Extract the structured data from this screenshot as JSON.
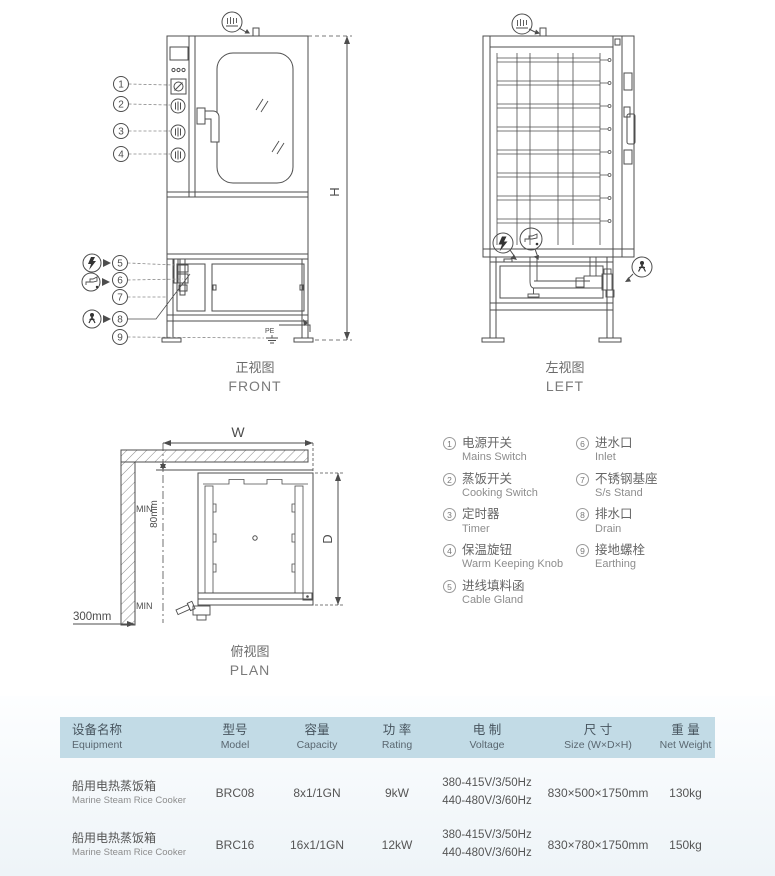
{
  "views": {
    "front": {
      "caption_zh": "正视图",
      "caption_en": "FRONT",
      "dim_h": "H",
      "pe_label": "PE",
      "callouts": [
        "1",
        "2",
        "3",
        "4",
        "5",
        "6",
        "7",
        "8",
        "9"
      ]
    },
    "left": {
      "caption_zh": "左视图",
      "caption_en": "LEFT"
    },
    "plan": {
      "caption_zh": "俯视图",
      "caption_en": "PLAN",
      "dim_w": "W",
      "dim_d": "D",
      "min_rear": "MIN",
      "dim_rear": "80mm",
      "min_side": "MIN",
      "dim_side": "300mm"
    }
  },
  "legend": {
    "items": [
      {
        "num": "1",
        "zh": "电源开关",
        "en": "Mains Switch"
      },
      {
        "num": "2",
        "zh": "蒸饭开关",
        "en": "Cooking Switch"
      },
      {
        "num": "3",
        "zh": "定时器",
        "en": "Timer"
      },
      {
        "num": "4",
        "zh": "保温旋钮",
        "en": "Warm Keeping Knob"
      },
      {
        "num": "5",
        "zh": "进线填料函",
        "en": "Cable Gland"
      },
      {
        "num": "6",
        "zh": "进水口",
        "en": "Inlet"
      },
      {
        "num": "7",
        "zh": "不锈钢基座",
        "en": "S/s Stand"
      },
      {
        "num": "8",
        "zh": "排水口",
        "en": "Drain"
      },
      {
        "num": "9",
        "zh": "接地螺栓",
        "en": "Earthing"
      }
    ]
  },
  "table": {
    "headers": [
      {
        "zh": "设备名称",
        "en": "Equipment"
      },
      {
        "zh": "型号",
        "en": "Model"
      },
      {
        "zh": "容量",
        "en": "Capacity"
      },
      {
        "zh": "功 率",
        "en": "Rating"
      },
      {
        "zh": "电 制",
        "en": "Voltage"
      },
      {
        "zh": "尺 寸",
        "en": "Size (W×D×H)"
      },
      {
        "zh": "重 量",
        "en": "Net Weight"
      }
    ],
    "rows": [
      {
        "equipment_zh": "船用电热蒸饭箱",
        "equipment_en": "Marine Steam Rice Cooker",
        "model": "BRC08",
        "capacity": "8x1/1GN",
        "rating": "9kW",
        "voltage_1": "380-415V/3/50Hz",
        "voltage_2": "440-480V/3/60Hz",
        "size": "830×500×1750mm",
        "weight": "130kg"
      },
      {
        "equipment_zh": "船用电热蒸饭箱",
        "equipment_en": "Marine Steam Rice Cooker",
        "model": "BRC16",
        "capacity": "16x1/1GN",
        "rating": "12kW",
        "voltage_1": "380-415V/3/50Hz",
        "voltage_2": "440-480V/3/60Hz",
        "size": "830×780×1750mm",
        "weight": "150kg"
      }
    ]
  },
  "colors": {
    "table_header_bg": "#c2dbe6",
    "line": "#4d4d4d"
  }
}
